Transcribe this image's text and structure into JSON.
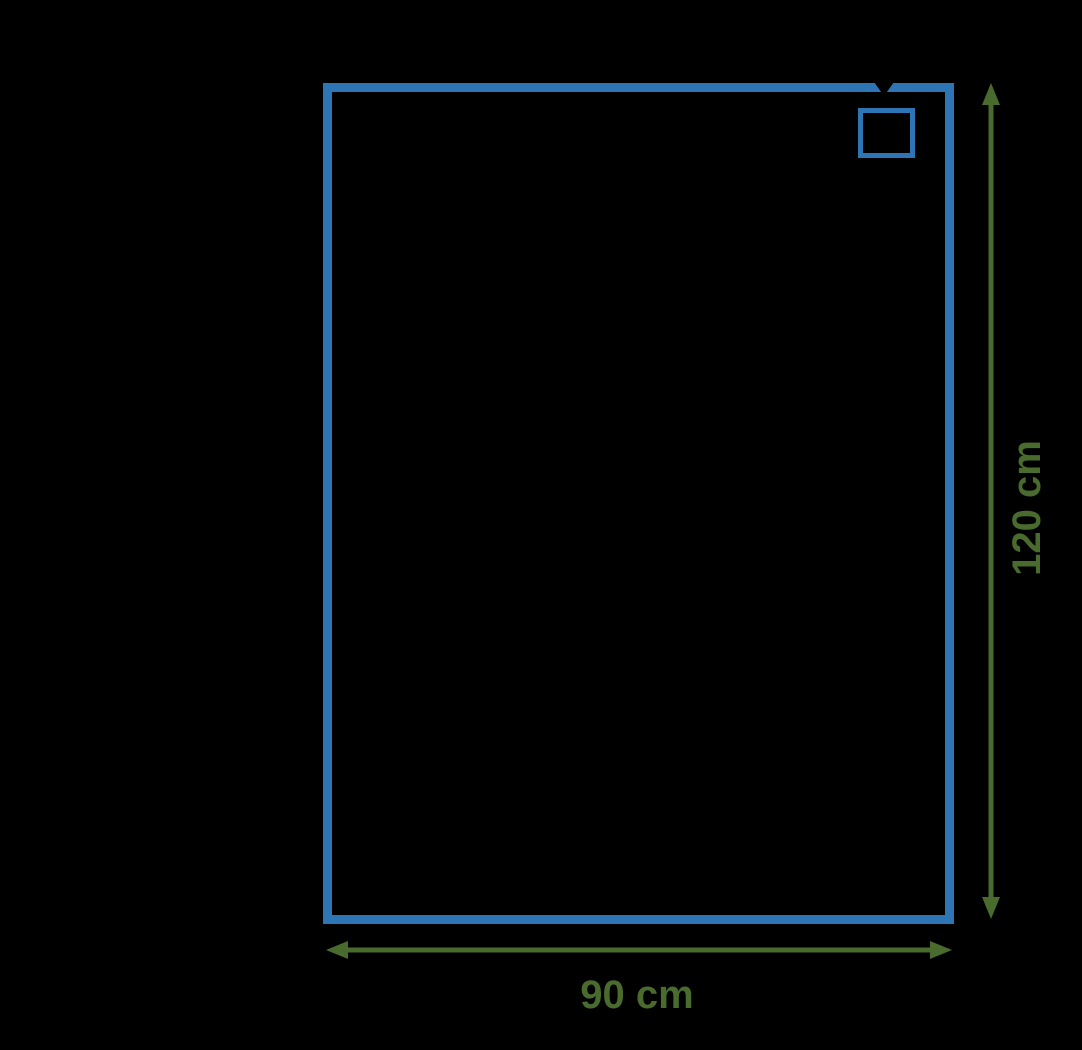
{
  "canvas": {
    "background": "#000000",
    "width": 1082,
    "height": 1050
  },
  "colors": {
    "rectangle_blue": "#2e75b6",
    "dimension_green": "#4a6b2e",
    "pointer_black": "#000000"
  },
  "shapes": {
    "outer_rectangle": {
      "stroke": "#2e75b6"
    },
    "inner_square": {
      "stroke": "#2e75b6"
    }
  },
  "dimensions": {
    "height": {
      "label": "120 cm",
      "color": "#4a6b2e"
    },
    "width": {
      "label": "90 cm",
      "color": "#4a6b2e"
    }
  },
  "pointer_arrow": {
    "color": "#000000"
  }
}
